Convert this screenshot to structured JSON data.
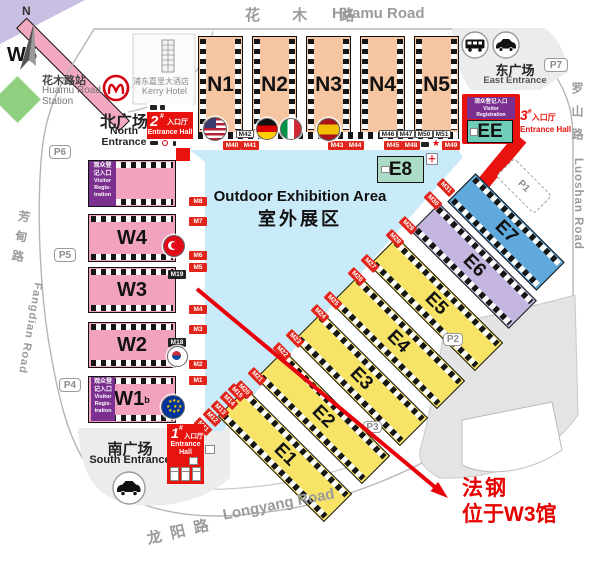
{
  "compass": {
    "label": "N"
  },
  "roads": {
    "top_cn": "花 木 路",
    "top_en": "Huamu Road",
    "right_cn": "罗山路",
    "right_en": "Luoshan Road",
    "left_cn": "芳甸路",
    "left_en": "Fangdian Road",
    "bottom_cn": "龙阳路",
    "bottom_en": "Longyang Road"
  },
  "station": {
    "cn": "花木路站",
    "en1": "Huamu Road",
    "en2": "Station"
  },
  "hotel": {
    "cn": "浦东嘉里大酒店",
    "en": "Kerry Hotel"
  },
  "plazas": {
    "north_cn": "北广场",
    "north_en1": "North",
    "north_en2": "Entrance",
    "south_cn": "南广场",
    "south_en": "South Entrance",
    "east_cn": "东广场",
    "east_en": "East Entrance"
  },
  "entrance_halls": {
    "one": "1",
    "two": "2",
    "three": "3",
    "sup": "#",
    "cn": "入口厅",
    "en": "Entrance Hall",
    "en1": "Entrance",
    "en2": "Hall"
  },
  "outdoor": {
    "en": "Outdoor Exhibition Area",
    "cn": "室外展区"
  },
  "visitor_registration": {
    "cn": "观众登记入口",
    "cn1": "观众登",
    "cn2": "记入口",
    "en1": "Visitor",
    "en2": "Regis-",
    "en3": "tration",
    "en_w1": "Visitor",
    "en_w2": "Registration"
  },
  "halls": {
    "north": [
      "N1",
      "N2",
      "N3",
      "N4",
      "N5"
    ],
    "west": [
      "W5",
      "W4",
      "W3",
      "W2",
      "W1"
    ],
    "west_sup": "b",
    "diagonal": [
      "E1",
      "E2",
      "E3",
      "E4",
      "E5",
      "E6",
      "E7"
    ],
    "e8": "E8",
    "ee": "EE"
  },
  "parking": [
    "P1",
    "P2",
    "P3",
    "P4",
    "P5",
    "P6",
    "P7"
  ],
  "gates": {
    "top_white": [
      "M42",
      "M46",
      "M47",
      "M50",
      "M51"
    ],
    "top_red": [
      "M40",
      "M41",
      "M43",
      "M44",
      "M45",
      "M48",
      "M49"
    ],
    "west": [
      "M8",
      "M7",
      "M6",
      "M5",
      "M4",
      "M3",
      "M2",
      "M1"
    ],
    "inner_dark": [
      "M19",
      "M18"
    ],
    "diag_nw": [
      "M20",
      "M21",
      "M22",
      "M23",
      "M24",
      "M25",
      "M26",
      "M27",
      "M28",
      "M29",
      "M30",
      "M31"
    ],
    "diag_sw": [
      "M11",
      "M12",
      "M13",
      "M14",
      "M15"
    ]
  },
  "icons": {
    "first_aid": "＋",
    "star": "★"
  },
  "annotation": {
    "line1": "法钢",
    "line2": "位于W3馆"
  },
  "colors": {
    "red": "#E8120E",
    "hall_north": "#F6C6A2",
    "hall_west": "#F0A2BE",
    "hall_yellow": "#F7E467",
    "hall_e6": "#C4B6DE",
    "hall_e7": "#5FA9DC",
    "hall_e8": "#AADCC6",
    "hall_ee": "#6FCDB9",
    "outdoor_blue": "#C9EAF8",
    "purple": "#7B2F8E",
    "green": "#8FD080",
    "pink": "#F3A9C0"
  }
}
